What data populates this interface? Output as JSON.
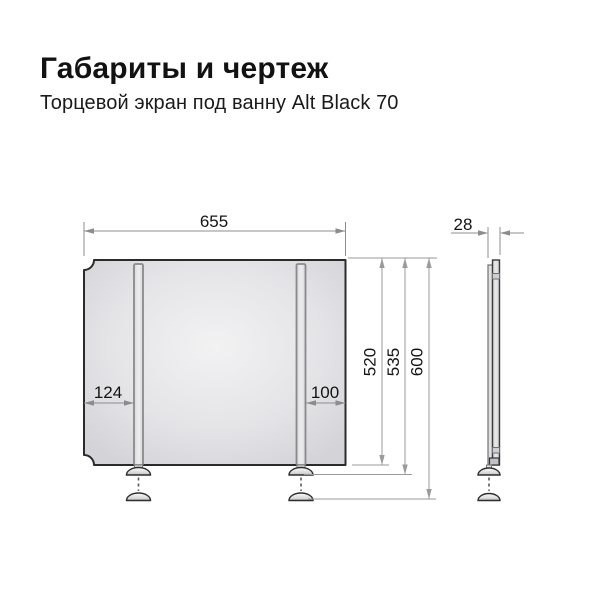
{
  "page": {
    "title": "Габариты и чертеж",
    "subtitle": "Торцевой экран под ванну Alt Black 70"
  },
  "drawing": {
    "front_view": {
      "width_mm": "655",
      "leg_offset_left_mm": "124",
      "leg_offset_right_mm": "100",
      "panel_height_mm": "520",
      "height_to_feet_mm": "535",
      "overall_height_mm": "600"
    },
    "side_view": {
      "thickness_mm": "28"
    },
    "colors": {
      "outline": "#2b2b2b",
      "dimension_line": "#8c8c8c",
      "panel_fill_light": "#f1f1f2",
      "panel_fill_dark": "#d6d6d9",
      "text": "#141414",
      "background": "#ffffff"
    }
  }
}
